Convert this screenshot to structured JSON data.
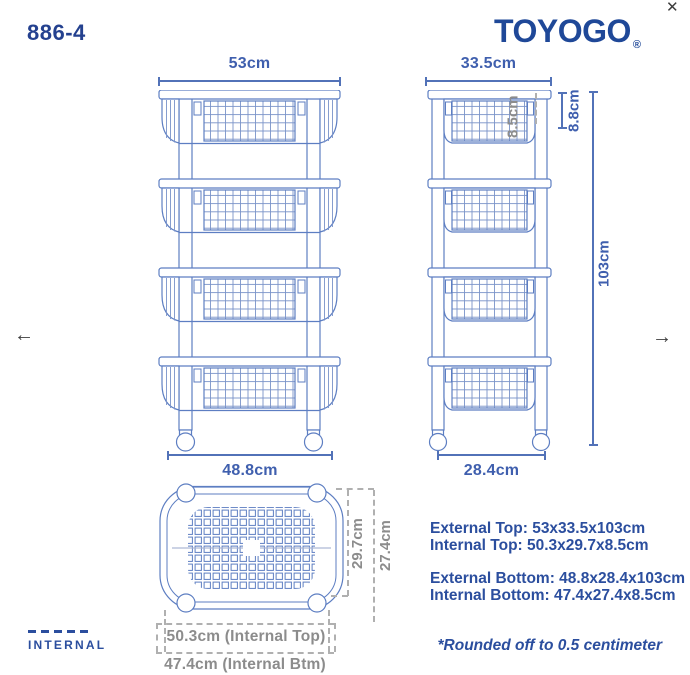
{
  "viewer": {
    "close_icon": "✕",
    "prev_icon": "←",
    "next_icon": "→"
  },
  "header": {
    "model_number": "886-4",
    "brand": "TOYOGO",
    "registered_mark": "®"
  },
  "front_view": {
    "top_width": "53cm",
    "bottom_width": "48.8cm"
  },
  "side_view": {
    "top_depth": "33.5cm",
    "bottom_depth": "28.4cm",
    "internal_height": "8.5cm",
    "basket_height": "8.8cm",
    "overall_height": "103cm"
  },
  "top_view": {
    "internal_top_depth": "29.7cm",
    "internal_bottom_depth": "27.4cm",
    "internal_top_width": "50.3cm (Internal Top)",
    "internal_bottom_width": "47.4cm (Internal Btm)"
  },
  "specs": {
    "external_top": "External Top: 53x33.5x103cm",
    "internal_top": "Internal Top: 50.3x29.7x8.5cm",
    "external_bottom": "External Bottom: 48.8x28.4x103cm",
    "internal_bottom": "Internal Bottom: 47.4x27.4x8.5cm",
    "note": "*Rounded off to 0.5 centimeter"
  },
  "legend": {
    "internal_label": "INTERNAL"
  },
  "colors": {
    "brand_blue": "#1f4898",
    "text_blue": "#2b4e9e",
    "dim_blue": "#5272b8",
    "line_blue": "#5d7ec2",
    "internal_gray": "#8c8c8c"
  }
}
